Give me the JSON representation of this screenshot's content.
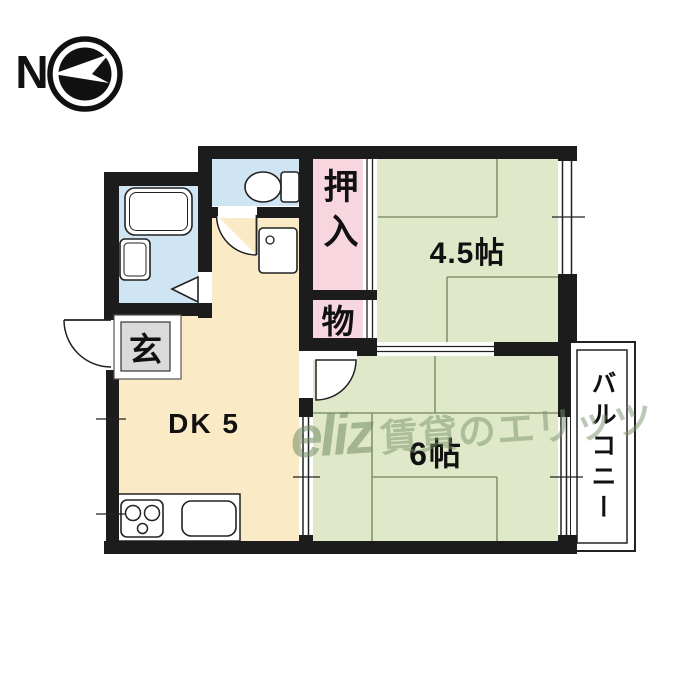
{
  "compass": {
    "north_label": "N"
  },
  "rooms": {
    "dk": {
      "label": "DK 5"
    },
    "washitsu_45": {
      "label": "4.5帖"
    },
    "washitsu_6": {
      "label": "6帖"
    },
    "oshiire": {
      "label": "押入"
    },
    "storage": {
      "label": "物"
    },
    "genkan": {
      "label": "玄"
    },
    "balcony": {
      "label": "バルコニー"
    }
  },
  "watermark": {
    "logo": "eliz",
    "text": "賃貸のエリッツ"
  },
  "colors": {
    "wall": "#1c1c1c",
    "water_blue": "#cfe5f3",
    "dk_yellow": "#faeac6",
    "tatami_green": "#dfe9ca",
    "closet_pink": "#f8d6e0",
    "genkan_gray": "#dadada",
    "tatami_line": "#84936f",
    "watermark_green": "#7d9070"
  }
}
